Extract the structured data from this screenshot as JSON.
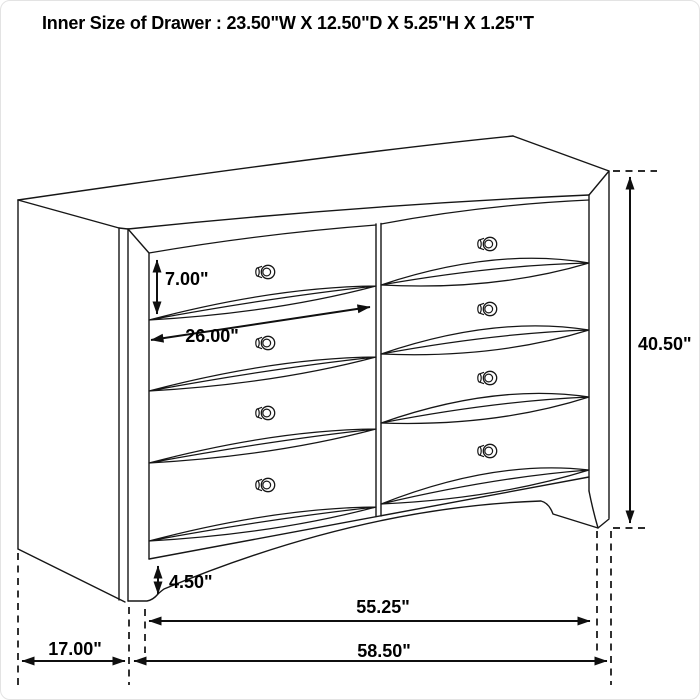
{
  "title": "Inner Size of Drawer : 23.50\"W X 12.50\"D X 5.25\"H X 1.25\"T",
  "figure": {
    "type": "furniture dimension line-drawing",
    "item": "eight-drawer dresser, two columns of four drawers, perspective view",
    "knob_count": 8
  },
  "dims": {
    "drawer_height": "7.00\"",
    "drawer_width": "26.00\"",
    "overall_height": "40.50\"",
    "base_height": "4.50\"",
    "case_width": "55.25\"",
    "overall_width": "58.50\"",
    "depth": "17.00\""
  },
  "colors": {
    "background": "#ffffff",
    "line": "#161616",
    "text": "#000000"
  }
}
